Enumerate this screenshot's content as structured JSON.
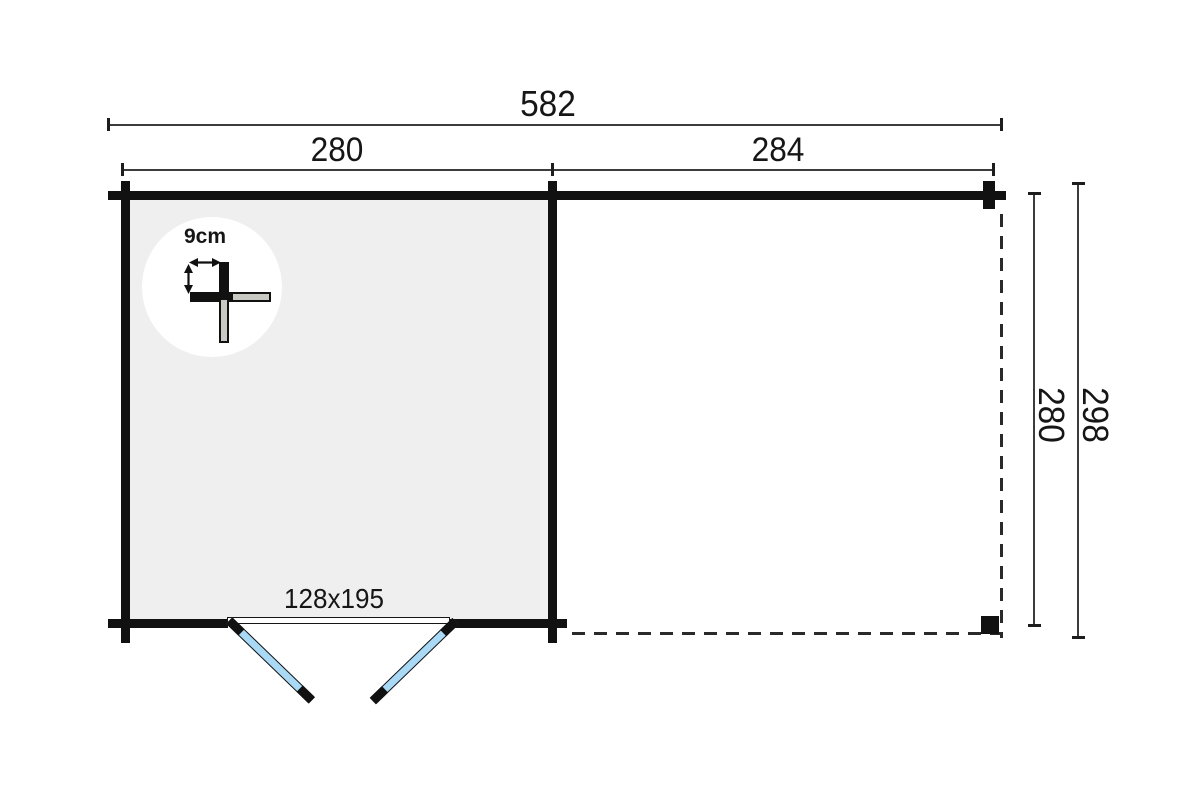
{
  "drawing": {
    "title": "log-cabin-floor-plan",
    "dims": {
      "total_width": "582",
      "cabin_width": "280",
      "canopy_width": "284",
      "inner_depth": "280",
      "total_depth": "298"
    },
    "door": {
      "size": "128x195"
    },
    "wall_detail": {
      "thickness": "9cm"
    },
    "colors": {
      "wall": "#111111",
      "interior_fill": "#efefef",
      "door_glass": "#a9d9f4",
      "dim_line": "#3c3c3c",
      "dash_line": "#2a2a2a",
      "neighbor_log_fill": "#c9c9c4",
      "detail_circle": "#ffffff"
    }
  }
}
